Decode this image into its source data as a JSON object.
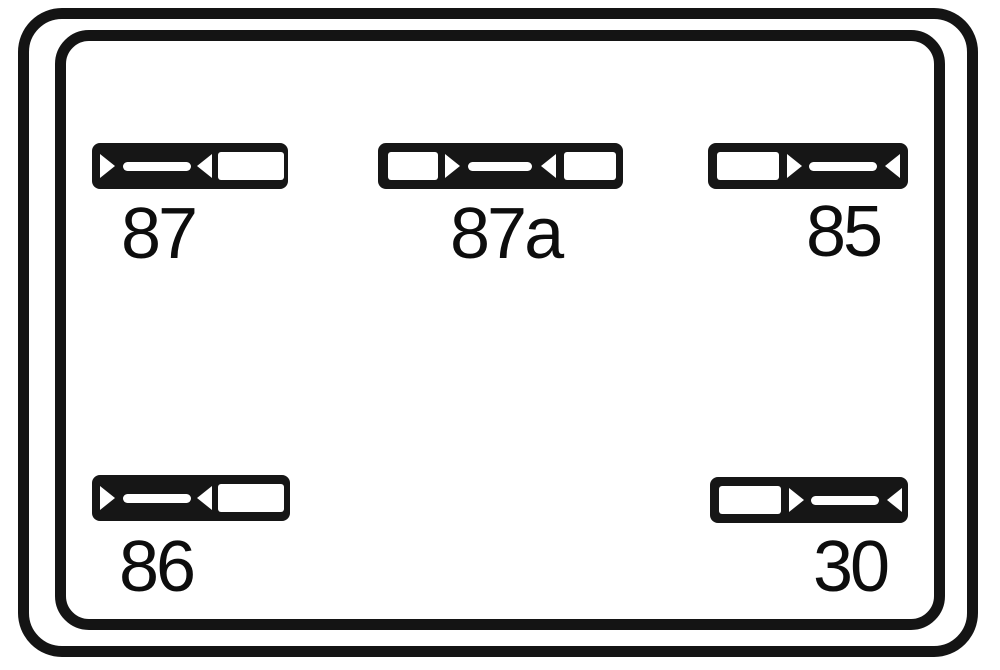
{
  "diagram": {
    "kind": "relay-terminal-layout",
    "colors": {
      "line": "#141414",
      "background": "#ffffff",
      "glyph": "#ffffff"
    }
  },
  "pins": [
    {
      "id": "87",
      "label": "87",
      "position": "top-left",
      "terminal_style": "blade-then-opening"
    },
    {
      "id": "87a",
      "label": "87a",
      "position": "top-center",
      "terminal_style": "opening-blade-opening"
    },
    {
      "id": "85",
      "label": "85",
      "position": "top-right",
      "terminal_style": "opening-then-blade"
    },
    {
      "id": "86",
      "label": "86",
      "position": "bottom-left",
      "terminal_style": "blade-then-opening"
    },
    {
      "id": "30",
      "label": "30",
      "position": "bottom-right",
      "terminal_style": "opening-then-blade"
    }
  ]
}
